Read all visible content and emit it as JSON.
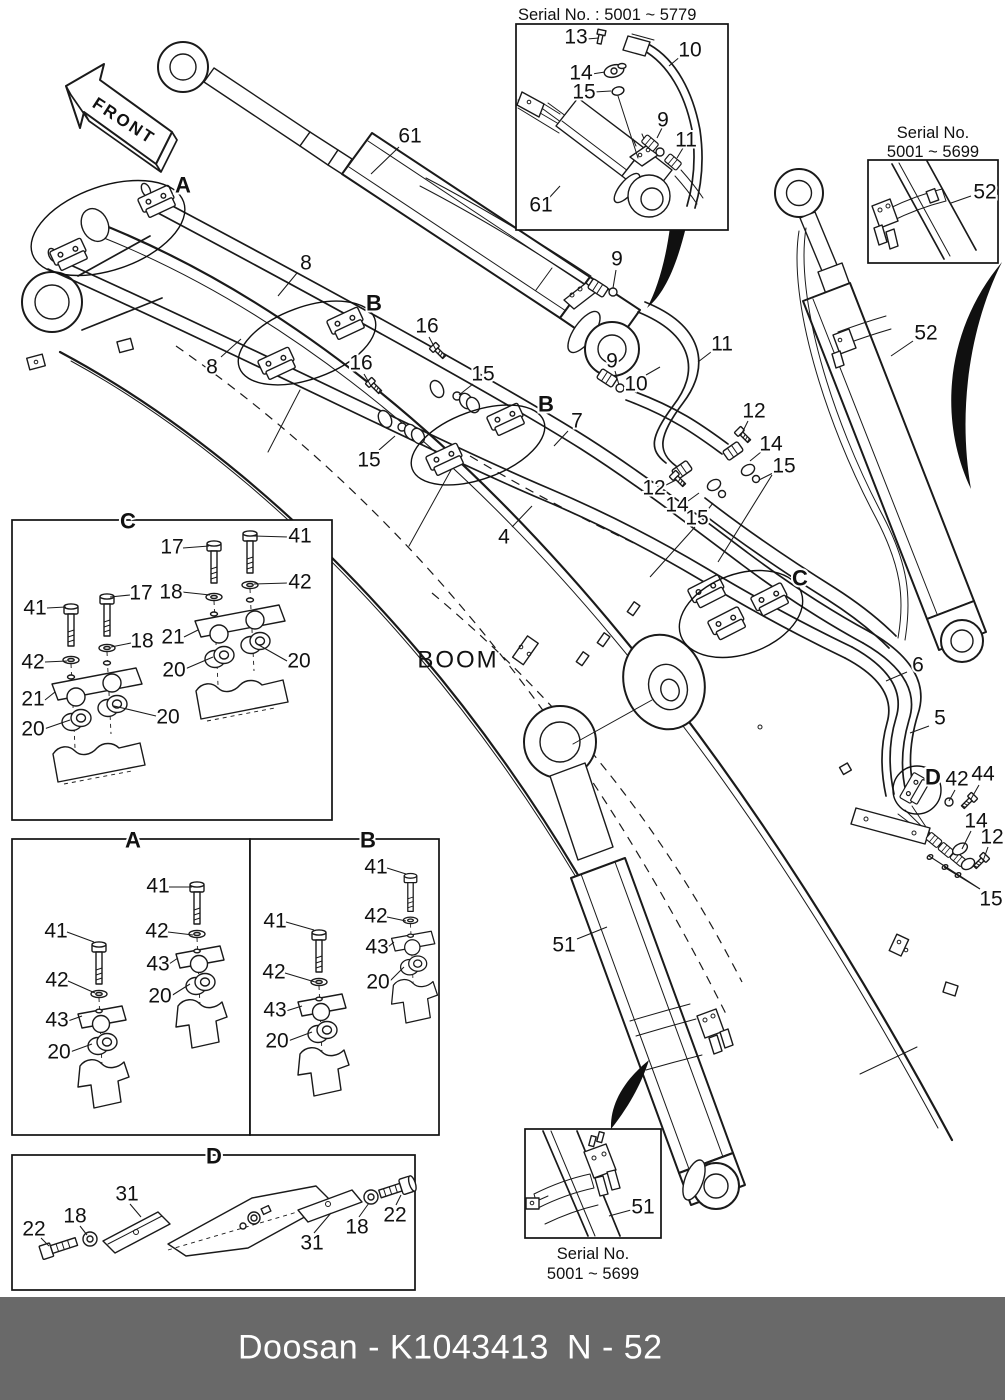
{
  "labels": {
    "front": "FRONT",
    "boom": "BOOM",
    "serial_top": "Serial No. : 5001 ~ 5779",
    "serial_right_1": "Serial No.",
    "serial_right_2": "5001 ~ 5699",
    "serial_bottom_1": "Serial No.",
    "serial_bottom_2": "5001 ~ 5699"
  },
  "footer": {
    "brand_part": "Doosan - K1043413",
    "page_ref": "N - 52"
  },
  "colors": {
    "line": "#1a1a1a",
    "background": "#ffffff",
    "footer_bg": "#696969",
    "footer_text": "#ffffff"
  },
  "sections": [
    "A",
    "B",
    "C",
    "D"
  ],
  "callouts": [
    {
      "t": "A",
      "x": 183,
      "y": 185,
      "b": true
    },
    {
      "t": "B",
      "x": 374,
      "y": 303,
      "b": true
    },
    {
      "t": "B",
      "x": 546,
      "y": 404,
      "b": true
    },
    {
      "t": "C",
      "x": 800,
      "y": 578,
      "b": true
    },
    {
      "t": "D",
      "x": 933,
      "y": 777,
      "b": true
    },
    {
      "t": "C",
      "x": 128,
      "y": 521,
      "b": true
    },
    {
      "t": "A",
      "x": 133,
      "y": 840,
      "b": true
    },
    {
      "t": "B",
      "x": 368,
      "y": 840,
      "b": true
    },
    {
      "t": "D",
      "x": 214,
      "y": 1156,
      "b": true
    },
    {
      "t": "61",
      "x": 410,
      "y": 136
    },
    {
      "t": "8",
      "x": 306,
      "y": 263
    },
    {
      "t": "8",
      "x": 212,
      "y": 367
    },
    {
      "t": "16",
      "x": 427,
      "y": 326
    },
    {
      "t": "16",
      "x": 361,
      "y": 363
    },
    {
      "t": "15",
      "x": 483,
      "y": 374
    },
    {
      "t": "15",
      "x": 369,
      "y": 460
    },
    {
      "t": "7",
      "x": 577,
      "y": 421
    },
    {
      "t": "4",
      "x": 504,
      "y": 537
    },
    {
      "t": "9",
      "x": 617,
      "y": 259
    },
    {
      "t": "9",
      "x": 612,
      "y": 361
    },
    {
      "t": "11",
      "x": 722,
      "y": 344
    },
    {
      "t": "10",
      "x": 636,
      "y": 384
    },
    {
      "t": "12",
      "x": 754,
      "y": 411
    },
    {
      "t": "14",
      "x": 771,
      "y": 444
    },
    {
      "t": "15",
      "x": 784,
      "y": 466
    },
    {
      "t": "12",
      "x": 654,
      "y": 488
    },
    {
      "t": "14",
      "x": 677,
      "y": 505
    },
    {
      "t": "15",
      "x": 697,
      "y": 518
    },
    {
      "t": "52",
      "x": 926,
      "y": 333
    },
    {
      "t": "6",
      "x": 918,
      "y": 665
    },
    {
      "t": "5",
      "x": 940,
      "y": 718
    },
    {
      "t": "42",
      "x": 957,
      "y": 779
    },
    {
      "t": "44",
      "x": 983,
      "y": 774
    },
    {
      "t": "14",
      "x": 976,
      "y": 821
    },
    {
      "t": "12",
      "x": 992,
      "y": 837
    },
    {
      "t": "15",
      "x": 991,
      "y": 899
    },
    {
      "t": "51",
      "x": 564,
      "y": 945
    },
    {
      "t": "13",
      "x": 576,
      "y": 37
    },
    {
      "t": "14",
      "x": 581,
      "y": 73
    },
    {
      "t": "15",
      "x": 584,
      "y": 92
    },
    {
      "t": "10",
      "x": 690,
      "y": 50
    },
    {
      "t": "9",
      "x": 663,
      "y": 120
    },
    {
      "t": "11",
      "x": 686,
      "y": 140
    },
    {
      "t": "61",
      "x": 541,
      "y": 205
    },
    {
      "t": "52",
      "x": 985,
      "y": 192
    },
    {
      "t": "17",
      "x": 172,
      "y": 547
    },
    {
      "t": "41",
      "x": 300,
      "y": 536
    },
    {
      "t": "42",
      "x": 300,
      "y": 582
    },
    {
      "t": "18",
      "x": 171,
      "y": 592
    },
    {
      "t": "17",
      "x": 141,
      "y": 593
    },
    {
      "t": "41",
      "x": 35,
      "y": 608
    },
    {
      "t": "21",
      "x": 173,
      "y": 637
    },
    {
      "t": "18",
      "x": 142,
      "y": 641
    },
    {
      "t": "42",
      "x": 33,
      "y": 662
    },
    {
      "t": "20",
      "x": 299,
      "y": 661
    },
    {
      "t": "20",
      "x": 174,
      "y": 670
    },
    {
      "t": "21",
      "x": 33,
      "y": 699
    },
    {
      "t": "20",
      "x": 168,
      "y": 717
    },
    {
      "t": "20",
      "x": 33,
      "y": 729
    },
    {
      "t": "41",
      "x": 158,
      "y": 886
    },
    {
      "t": "42",
      "x": 157,
      "y": 931
    },
    {
      "t": "43",
      "x": 158,
      "y": 964
    },
    {
      "t": "20",
      "x": 160,
      "y": 996
    },
    {
      "t": "41",
      "x": 56,
      "y": 931
    },
    {
      "t": "42",
      "x": 57,
      "y": 980
    },
    {
      "t": "43",
      "x": 57,
      "y": 1020
    },
    {
      "t": "20",
      "x": 59,
      "y": 1052
    },
    {
      "t": "41",
      "x": 376,
      "y": 867
    },
    {
      "t": "42",
      "x": 376,
      "y": 916
    },
    {
      "t": "43",
      "x": 377,
      "y": 947
    },
    {
      "t": "20",
      "x": 378,
      "y": 982
    },
    {
      "t": "41",
      "x": 275,
      "y": 921
    },
    {
      "t": "42",
      "x": 274,
      "y": 972
    },
    {
      "t": "43",
      "x": 275,
      "y": 1010
    },
    {
      "t": "20",
      "x": 277,
      "y": 1041
    },
    {
      "t": "22",
      "x": 34,
      "y": 1229
    },
    {
      "t": "18",
      "x": 75,
      "y": 1216
    },
    {
      "t": "31",
      "x": 127,
      "y": 1194
    },
    {
      "t": "31",
      "x": 312,
      "y": 1243
    },
    {
      "t": "18",
      "x": 357,
      "y": 1227
    },
    {
      "t": "22",
      "x": 395,
      "y": 1215
    },
    {
      "t": "51",
      "x": 643,
      "y": 1207
    }
  ]
}
